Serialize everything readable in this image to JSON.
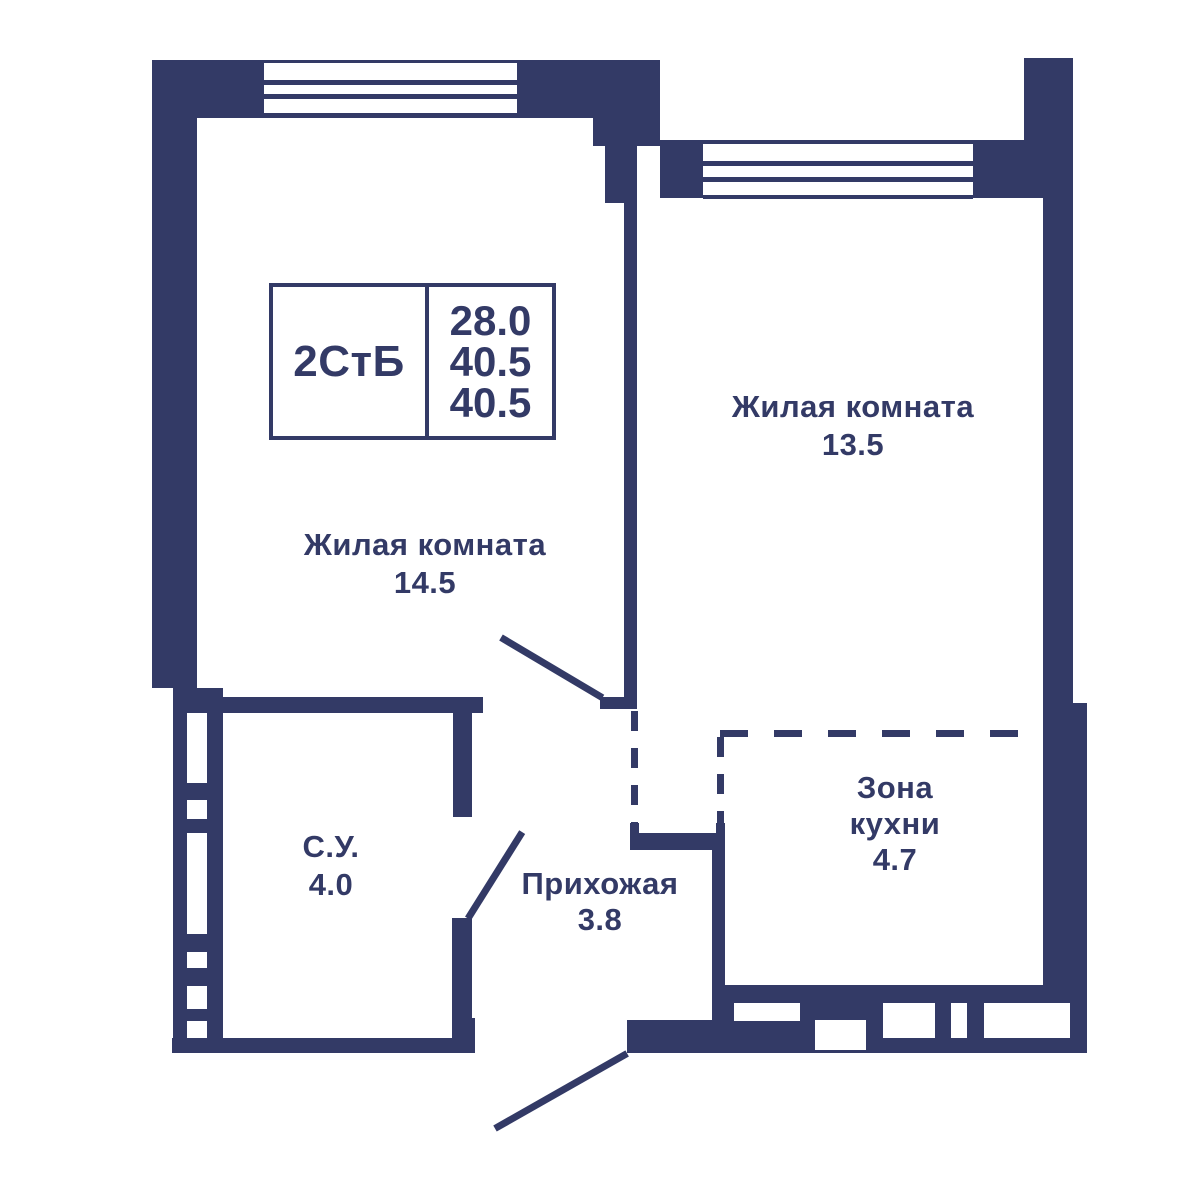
{
  "floorplan": {
    "info_box": {
      "type_label": "2СтБ",
      "values": [
        "28.0",
        "40.5",
        "40.5"
      ]
    },
    "rooms": {
      "living1": {
        "name": "Жилая комната",
        "area": "14.5"
      },
      "living2": {
        "name": "Жилая комната",
        "area": "13.5"
      },
      "kitchen": {
        "name_line1": "Зона",
        "name_line2": "кухни",
        "area": "4.7"
      },
      "bathroom": {
        "name": "С.У.",
        "area": "4.0"
      },
      "hallway": {
        "name": "Прихожая",
        "area": "3.8"
      }
    },
    "colors": {
      "wall": "#333a66",
      "background": "#ffffff"
    }
  }
}
